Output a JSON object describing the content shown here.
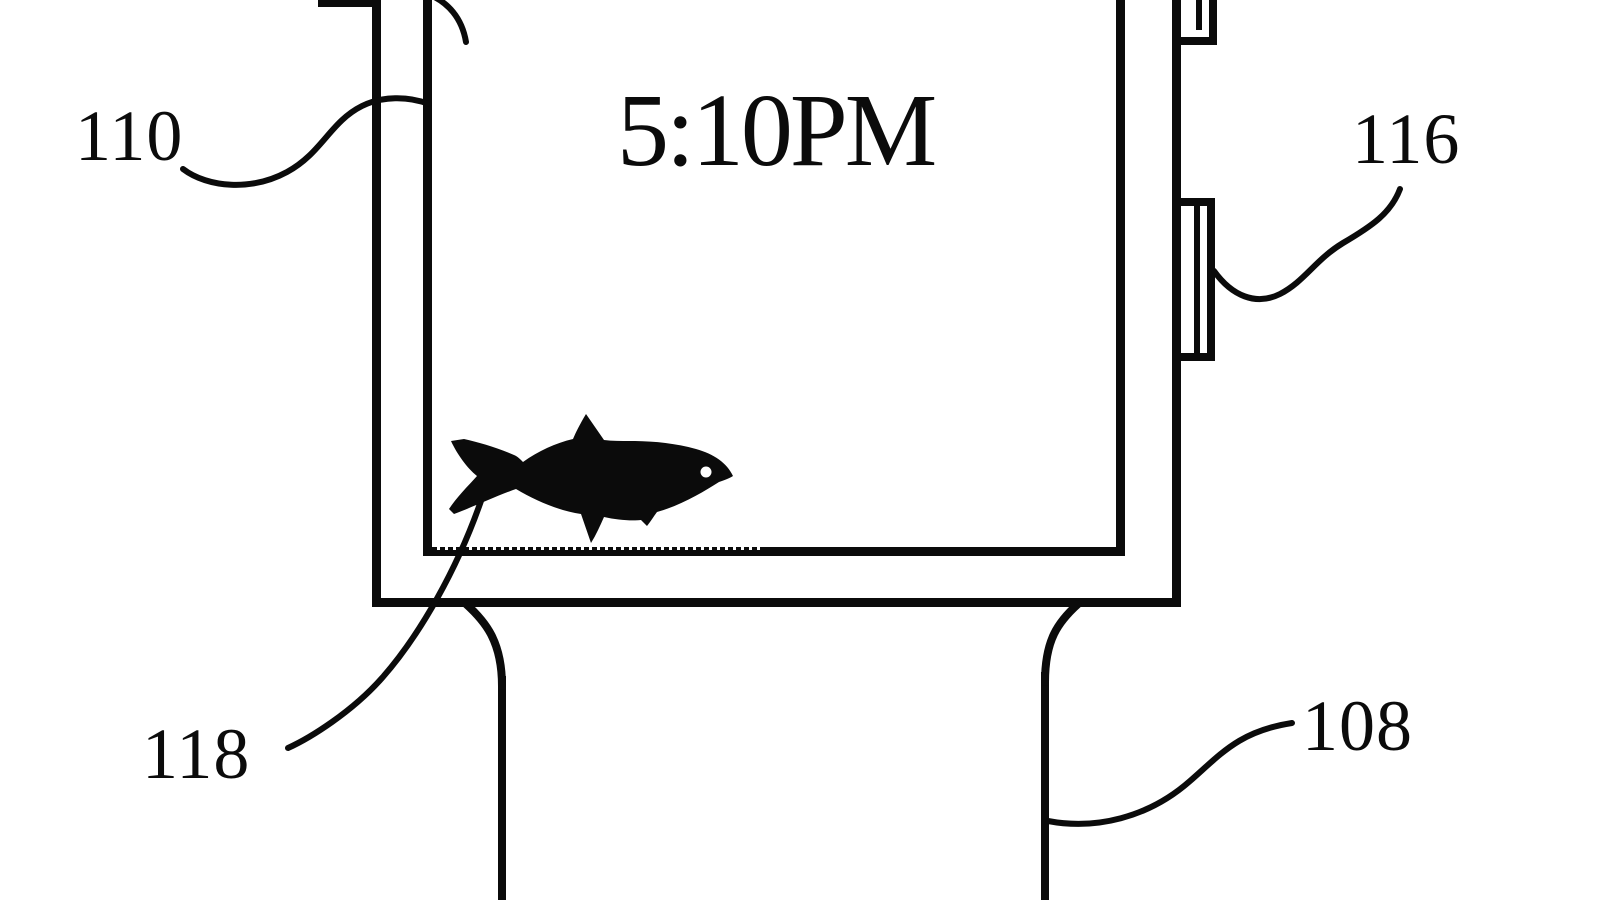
{
  "diagram": {
    "device": "smartwatch patent drawing",
    "display": {
      "time": "5:10PM",
      "icon": "fish-silhouette"
    },
    "labels": {
      "ref_110": "110",
      "ref_116": "116",
      "ref_118": "118",
      "ref_108": "108"
    },
    "colors": {
      "ink": "#0b0b0b",
      "background": "#ffffff"
    }
  }
}
